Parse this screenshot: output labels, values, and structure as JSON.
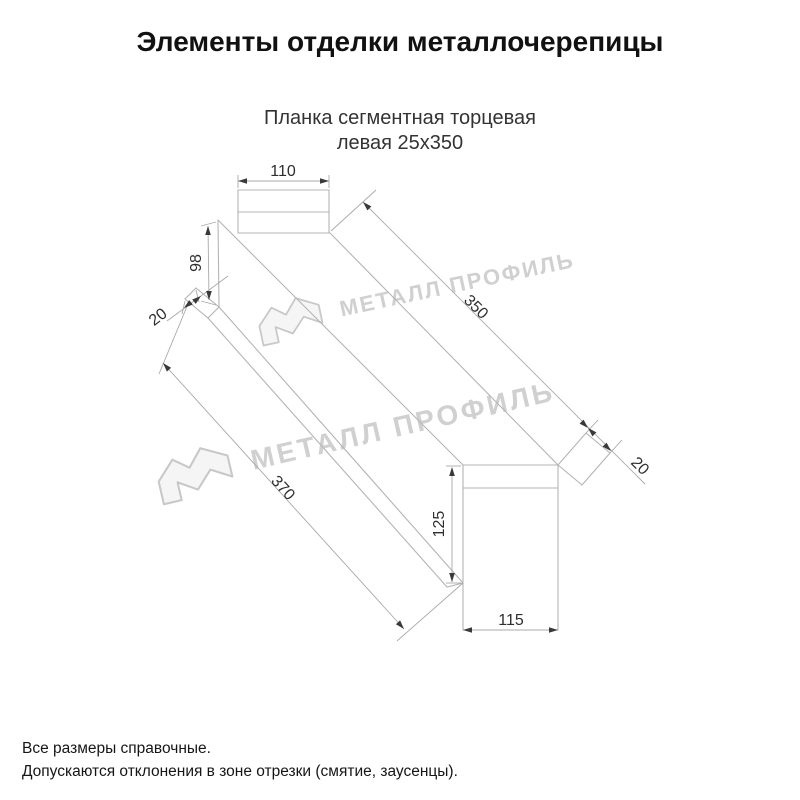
{
  "header": {
    "title": "Элементы отделки металлочерепицы"
  },
  "product": {
    "name_line1": "Планка сегментная торцевая",
    "name_line2": "левая 25х350"
  },
  "watermark": {
    "text": "МЕТАЛЛ ПРОФИЛЬ",
    "color": "#d0d0d0"
  },
  "drawing": {
    "type": "technical-drawing",
    "subject": "left segmental end trim strip, sketch view with dimensions",
    "dimensions": {
      "top_flange_width": "110",
      "near_end_height": "98",
      "near_hem": "20",
      "top_edge_length": "350",
      "bottom_edge_length": "370",
      "far_hem": "20",
      "far_end_height": "125",
      "far_end_width": "115"
    },
    "line_color": "#b4b4b4",
    "dimension_color": "#2e2e2e"
  },
  "footer": {
    "note1": "Все размеры справочные.",
    "note2": "Допускаются отклонения в зоне отрезки (смятие, заусенцы)."
  }
}
